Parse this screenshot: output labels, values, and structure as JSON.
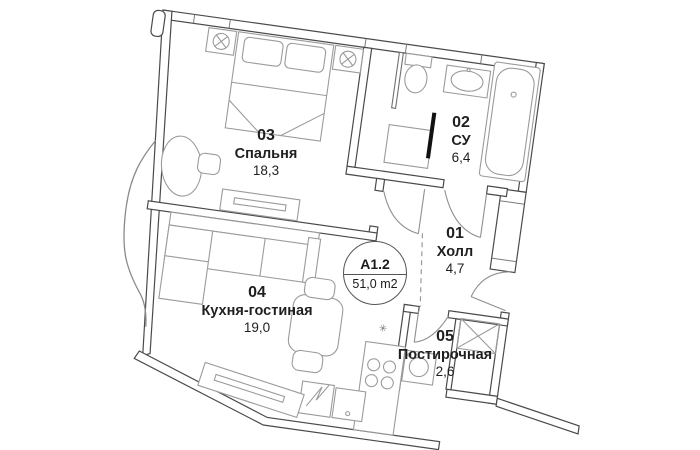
{
  "plan": {
    "unit_badge": {
      "code": "A1.2",
      "area": "51,0 m2"
    },
    "rooms": [
      {
        "number": "03",
        "name": "Спальня",
        "area": "18,3"
      },
      {
        "number": "02",
        "name": "СУ",
        "area": "6,4"
      },
      {
        "number": "01",
        "name": "Холл",
        "area": "4,7"
      },
      {
        "number": "04",
        "name": "Кухня-гостиная",
        "area": "19,0"
      },
      {
        "number": "05",
        "name": "Постирочная",
        "area": "2,6"
      }
    ],
    "symbols": {
      "kitchen_outlet": "✳"
    },
    "colors": {
      "wall": "#4a4a4a",
      "furniture": "#979797",
      "accent_black": "#111111"
    }
  }
}
